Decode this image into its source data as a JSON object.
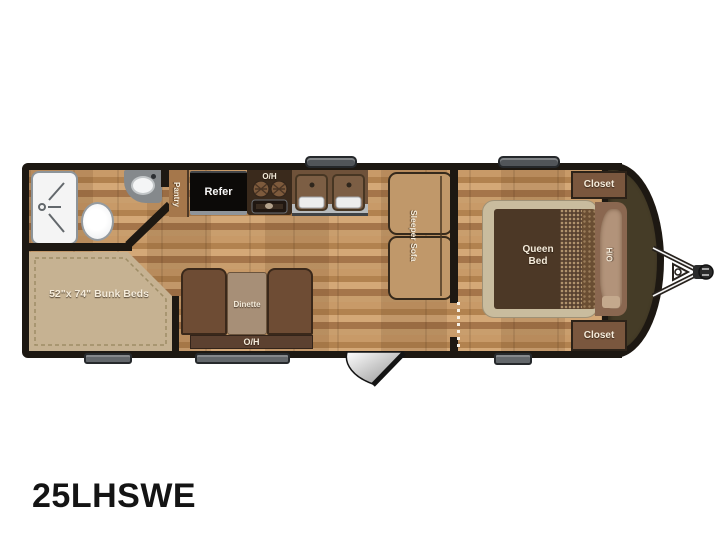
{
  "model_label": "25LHSWE",
  "rooms": {
    "bunk": {
      "label": "52\"x 74\" Bunk Beds"
    },
    "pantry": {
      "label": "Pantry"
    },
    "kitchen": {
      "refer_label": "Refer",
      "overhead_label": "O/H"
    },
    "dinette": {
      "label": "Dinette",
      "overhead_label": "O/H"
    },
    "sofa": {
      "label": "Sleeper Sofa"
    },
    "bedroom": {
      "queen_line1": "Queen",
      "queen_line2": "Bed",
      "overhead_label": "O/H",
      "closet_top": "Closet",
      "closet_bottom": "Closet"
    }
  },
  "colors": {
    "wall": "#1d1812",
    "floor_base": "#bf9160",
    "front_cap": "#453c27",
    "bunk_mattress": "#c6b292",
    "dinette_bench": "#6e4c34",
    "dinette_table": "#a78f77",
    "sofa": "#c0986a",
    "bed_comforter": "#4c3826",
    "bed_base": "#c9bc9e",
    "closet": "#7a573e",
    "label_text": "#f5ecdb",
    "hardware_gray": "#63676b"
  }
}
